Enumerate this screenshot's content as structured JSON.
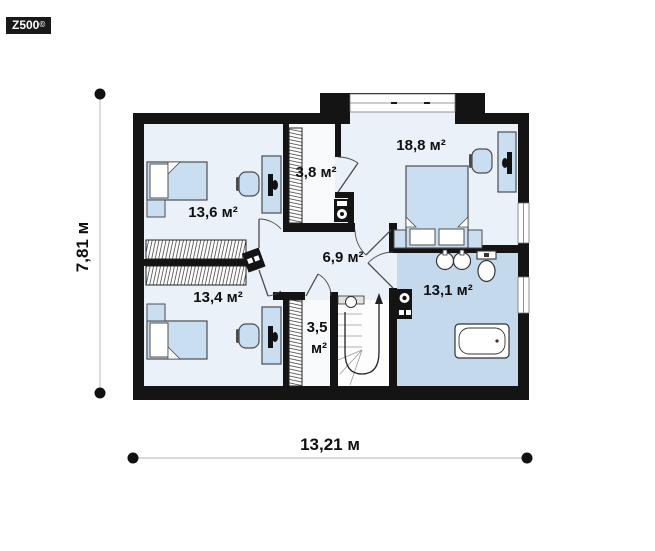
{
  "logo": {
    "brand": "Z500",
    "registered": "©"
  },
  "dimensions": {
    "horizontal": "13,21 м",
    "vertical": "7,81 м"
  },
  "rooms": {
    "bedroom_top_left": {
      "label": "13,6 м²",
      "furniture": [
        "single-bed",
        "nightstand",
        "desk",
        "office-chair",
        "wardrobe"
      ]
    },
    "closet_top": {
      "label": "3,8 м²",
      "furniture": [
        "wardrobe",
        "water-heater"
      ]
    },
    "bedroom_master": {
      "label": "18,8 м²",
      "furniture": [
        "double-bed",
        "two-nightstands",
        "desk",
        "office-chair"
      ]
    },
    "hall": {
      "label": "6,9 м²",
      "furniture": []
    },
    "bedroom_bottom_left": {
      "label": "13,4 м²",
      "furniture": [
        "single-bed",
        "nightstand",
        "desk",
        "office-chair",
        "wardrobe"
      ]
    },
    "closet_bottom": {
      "value": "3,5",
      "unit": "м²",
      "furniture": [
        "wardrobe"
      ]
    },
    "bathroom": {
      "label": "13,1 м²",
      "furniture": [
        "double-sink",
        "toilet",
        "bathtub",
        "washing-machine"
      ]
    },
    "staircase": {
      "furniture": [
        "u-shaped-stairs",
        "up-arrow"
      ]
    }
  },
  "colors": {
    "wall": "#141414",
    "floor": "#eaf1f8",
    "bathroom_floor": "#c4d9ec",
    "closet_floor": "#f8fafc",
    "furniture_fill": "#cadef2",
    "logo_bg": "#191919"
  }
}
